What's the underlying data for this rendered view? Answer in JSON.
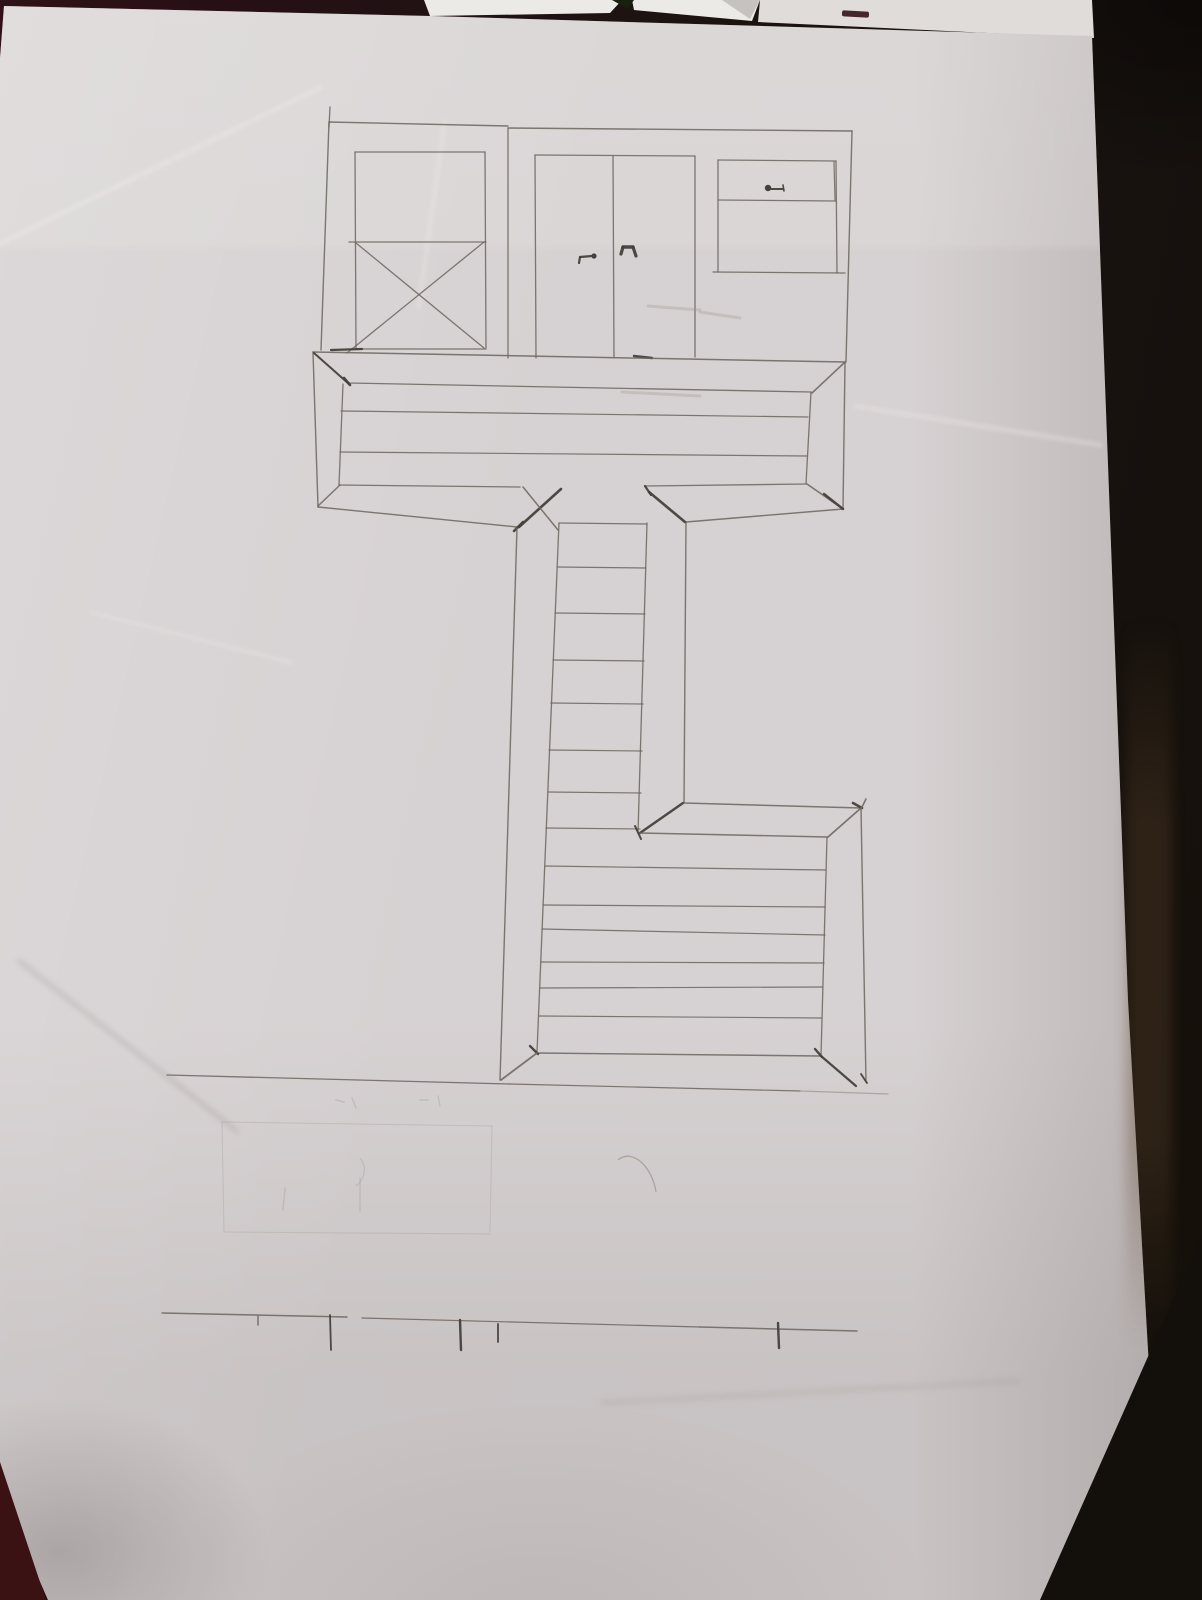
{
  "photo": {
    "colors": {
      "background_left": "#2e1217",
      "background_mid": "#1d1311",
      "background_right": "#141009",
      "paper": "#d6d1d2",
      "backing_sheet": "#eceae7",
      "red_object": "#46262a",
      "pencil": "#6e6862",
      "pencil_dark": "#45403b",
      "pencil_light": "#8a847e",
      "pencil_erased": "#9a948e"
    }
  },
  "drawing": {
    "stroke_styles": {
      "0": {
        "color": "#6e6862",
        "opacity": 0.88
      },
      "1": {
        "color": "#45403b",
        "opacity": 0.95
      },
      "2": {
        "color": "#8a847e",
        "opacity": 0.55
      },
      "3": {
        "color": "#9a948e",
        "opacity": 0.3
      }
    },
    "segments": [
      [
        329,
        122,
        508,
        126,
        1.4,
        0
      ],
      [
        508,
        128,
        852,
        131,
        1.4,
        0
      ],
      [
        330,
        107,
        329,
        127,
        1.3,
        0
      ],
      [
        329,
        122,
        321,
        350,
        1.4,
        0
      ],
      [
        852,
        131,
        846,
        362,
        1.4,
        0
      ],
      [
        355,
        152,
        485,
        152,
        1.3,
        0
      ],
      [
        355,
        152,
        356,
        349,
        1.3,
        0
      ],
      [
        485,
        152,
        486,
        348,
        1.3,
        0
      ],
      [
        349,
        242,
        486,
        242,
        1.3,
        0
      ],
      [
        355,
        349,
        486,
        349,
        1.3,
        0
      ],
      [
        356,
        243,
        484,
        348,
        1.3,
        0
      ],
      [
        484,
        242,
        347,
        353,
        1.3,
        0
      ],
      [
        331,
        350,
        362,
        349,
        2.2,
        1
      ],
      [
        508,
        128,
        508,
        358,
        1.3,
        0
      ],
      [
        535,
        155,
        695,
        156,
        1.3,
        0
      ],
      [
        535,
        155,
        536,
        358,
        1.3,
        0
      ],
      [
        613,
        156,
        614,
        357,
        1.3,
        0
      ],
      [
        695,
        156,
        695,
        357,
        1.3,
        0
      ],
      [
        579,
        263,
        580,
        257,
        2.2,
        1
      ],
      [
        580,
        257,
        592,
        256,
        2.2,
        1
      ],
      [
        621,
        254,
        623,
        247,
        3.2,
        1
      ],
      [
        623,
        247,
        633,
        247,
        3.4,
        1
      ],
      [
        633,
        247,
        636,
        256,
        3.2,
        1
      ],
      [
        634,
        356,
        652,
        358,
        2.4,
        1
      ],
      [
        718,
        160,
        836,
        161,
        1.3,
        0
      ],
      [
        718,
        160,
        718,
        272,
        1.3,
        0
      ],
      [
        836,
        161,
        837,
        273,
        1.3,
        0
      ],
      [
        834,
        162,
        835,
        200,
        1.2,
        0
      ],
      [
        718,
        200,
        836,
        201,
        1.3,
        0
      ],
      [
        713,
        272,
        845,
        273,
        1.3,
        0
      ],
      [
        771,
        189,
        783,
        189,
        2.0,
        1
      ],
      [
        783,
        185,
        784,
        191,
        1.6,
        1
      ],
      [
        313,
        352,
        845,
        362,
        1.5,
        0
      ],
      [
        313,
        352,
        318,
        507,
        1.4,
        0
      ],
      [
        845,
        362,
        843,
        509,
        1.4,
        0
      ],
      [
        318,
        507,
        517,
        527,
        1.4,
        0
      ],
      [
        686,
        522,
        843,
        509,
        1.4,
        0
      ],
      [
        348,
        383,
        811,
        392,
        1.3,
        0
      ],
      [
        343,
        384,
        339,
        485,
        1.3,
        0
      ],
      [
        811,
        392,
        806,
        484,
        1.3,
        0
      ],
      [
        339,
        485,
        520,
        487,
        1.3,
        0
      ],
      [
        646,
        486,
        806,
        484,
        1.3,
        0
      ],
      [
        341,
        411,
        808,
        417,
        1.2,
        0
      ],
      [
        340,
        452,
        807,
        456,
        1.2,
        0
      ],
      [
        314,
        353,
        349,
        384,
        2.0,
        1
      ],
      [
        344,
        378,
        350,
        385,
        2.6,
        1
      ],
      [
        844,
        363,
        812,
        393,
        1.6,
        0
      ],
      [
        318,
        506,
        340,
        485,
        1.5,
        0
      ],
      [
        843,
        509,
        807,
        484,
        1.6,
        0
      ],
      [
        824,
        494,
        843,
        509,
        2.4,
        1
      ],
      [
        519,
        527,
        561,
        489,
        2.6,
        1
      ],
      [
        523,
        487,
        558,
        530,
        1.5,
        0
      ],
      [
        514,
        531,
        523,
        522,
        2.6,
        1
      ],
      [
        649,
        492,
        685,
        522,
        2.6,
        1
      ],
      [
        645,
        486,
        651,
        495,
        2.2,
        1
      ],
      [
        517,
        528,
        500,
        1080,
        1.4,
        0
      ],
      [
        686,
        523,
        684,
        803,
        1.4,
        0
      ],
      [
        559,
        523,
        537,
        1052,
        1.3,
        0
      ],
      [
        647,
        523,
        638,
        833,
        1.3,
        0
      ],
      [
        559,
        523,
        647,
        524,
        1.3,
        0
      ],
      [
        557,
        567,
        646,
        568,
        1.2,
        0
      ],
      [
        555,
        613,
        645,
        614,
        1.2,
        0
      ],
      [
        553,
        660,
        644,
        661,
        1.2,
        0
      ],
      [
        551,
        703,
        643,
        704,
        1.2,
        0
      ],
      [
        549,
        750,
        642,
        751,
        1.2,
        0
      ],
      [
        548,
        792,
        641,
        793,
        1.2,
        0
      ],
      [
        546,
        828,
        640,
        829,
        1.2,
        0
      ],
      [
        640,
        833,
        683,
        803,
        2.4,
        1
      ],
      [
        635,
        826,
        641,
        839,
        2.0,
        1
      ],
      [
        640,
        833,
        827,
        837,
        1.4,
        0
      ],
      [
        684,
        803,
        861,
        808,
        1.5,
        0
      ],
      [
        853,
        803,
        862,
        808,
        2.6,
        1
      ],
      [
        866,
        799,
        861,
        809,
        1.6,
        0
      ],
      [
        861,
        808,
        828,
        837,
        1.8,
        0
      ],
      [
        861,
        808,
        866,
        1082,
        1.4,
        0
      ],
      [
        827,
        837,
        821,
        1056,
        1.3,
        0
      ],
      [
        545,
        866,
        826,
        870,
        1.2,
        0
      ],
      [
        543,
        905,
        825,
        907,
        1.2,
        0
      ],
      [
        542,
        929,
        825,
        935,
        1.2,
        0
      ],
      [
        541,
        962,
        824,
        963,
        1.2,
        0
      ],
      [
        540,
        988,
        823,
        987,
        1.2,
        0
      ],
      [
        539,
        1016,
        822,
        1018,
        1.2,
        0
      ],
      [
        537,
        1053,
        821,
        1056,
        1.4,
        0
      ],
      [
        530,
        1046,
        538,
        1054,
        2.4,
        1
      ],
      [
        815,
        1049,
        822,
        1057,
        2.4,
        1
      ],
      [
        501,
        1080,
        537,
        1053,
        1.8,
        0
      ],
      [
        821,
        1056,
        856,
        1086,
        2.2,
        1
      ],
      [
        861,
        1074,
        867,
        1083,
        1.8,
        1
      ],
      [
        167,
        1075,
        510,
        1084,
        1.3,
        0
      ],
      [
        510,
        1084,
        800,
        1091,
        1.2,
        0
      ],
      [
        800,
        1091,
        888,
        1094,
        1.2,
        2
      ],
      [
        162,
        1313,
        347,
        1317,
        1.5,
        0
      ],
      [
        362,
        1318,
        700,
        1327,
        1.2,
        0
      ],
      [
        700,
        1327,
        857,
        1331,
        1.5,
        0
      ],
      [
        258,
        1316,
        258,
        1325,
        1.5,
        0
      ],
      [
        330,
        1315,
        331,
        1350,
        1.8,
        1
      ],
      [
        460,
        1320,
        461,
        1350,
        2.4,
        1
      ],
      [
        498,
        1324,
        498,
        1342,
        1.8,
        1
      ],
      [
        778,
        1323,
        779,
        1348,
        2.4,
        1
      ],
      [
        222,
        1122,
        492,
        1126,
        1.0,
        3
      ],
      [
        222,
        1122,
        224,
        1232,
        1.0,
        3
      ],
      [
        492,
        1126,
        490,
        1232,
        1.0,
        3
      ],
      [
        224,
        1232,
        490,
        1234,
        1.0,
        3
      ],
      [
        285,
        1188,
        283,
        1210,
        1.4,
        3
      ],
      [
        360,
        1178,
        360,
        1212,
        1.4,
        3
      ],
      [
        336,
        1100,
        344,
        1102,
        1.6,
        3
      ],
      [
        352,
        1098,
        356,
        1108,
        1.4,
        3
      ],
      [
        420,
        1100,
        428,
        1100,
        1.4,
        3
      ],
      [
        438,
        1096,
        440,
        1106,
        1.4,
        3
      ],
      [
        648,
        306,
        700,
        310,
        3.0,
        3
      ],
      [
        700,
        312,
        740,
        318,
        3.0,
        3
      ],
      [
        622,
        392,
        700,
        396,
        3.0,
        3
      ]
    ],
    "dots": [
      [
        768,
        188,
        3.2
      ],
      [
        594,
        256,
        2.6
      ]
    ],
    "paths": [
      {
        "d": "M618,1160 C632,1148 652,1166 656,1192",
        "shade": "2"
      },
      {
        "d": "M360,1158 C368,1168 364,1180 356,1186",
        "shade": "3"
      }
    ]
  }
}
